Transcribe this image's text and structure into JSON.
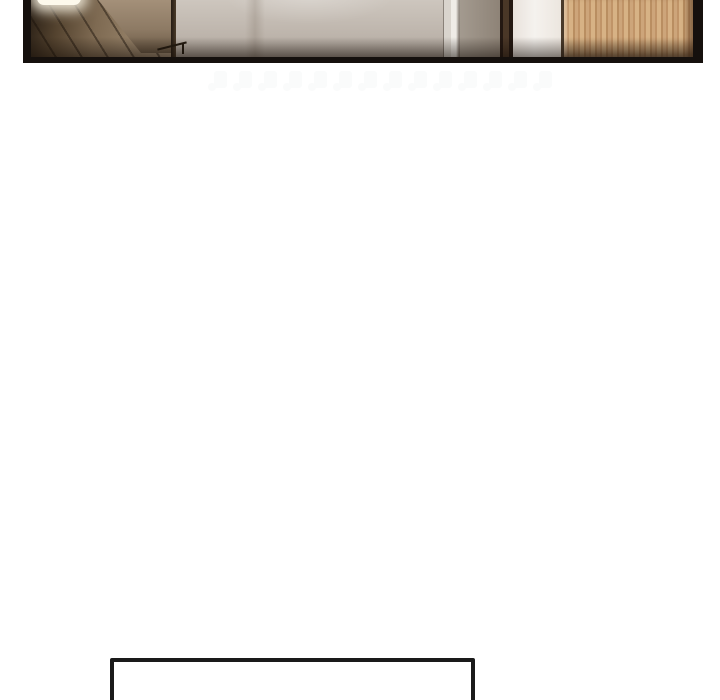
{
  "page": {
    "kind": "webtoon-comic-page"
  },
  "panel": {
    "alt": "Cropped photographic comic panel of a modern interior: dark wood hallway with a bright ceiling light on the left, a stair railing, a beige plaster wall in the center, and a dark door frame, white trim and light oak wood panel on the right, all inside a black frame"
  },
  "colors": {
    "page_bg": "#ffffff",
    "frame": "#15100d",
    "wall_beige": "#b9b0a7",
    "wall_beige_light": "#cfc8c0",
    "wood_dark": "#2a2016",
    "wood_mid": "#7e6a52",
    "glow": "#fdf9ec",
    "rail": "#241b11",
    "door_edge": "#4a3727",
    "white_trim": "#f5f2ee",
    "oak": "#cda57a",
    "oak_light": "#d7b285",
    "oak_dark": "#b98e61",
    "watermark": "#fafbfb",
    "caption_border": "#1a1a1a",
    "caption_bg": "#ffffff"
  },
  "watermark": {
    "repeat_count": 14
  },
  "caption_box": {
    "text": ""
  }
}
